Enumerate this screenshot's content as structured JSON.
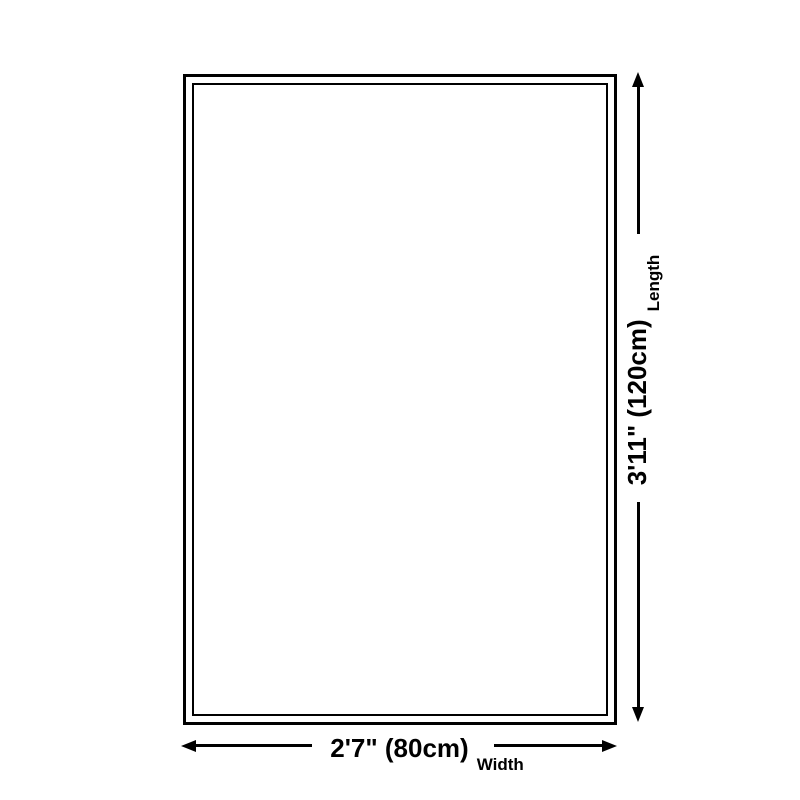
{
  "page": {
    "background_color": "#ffffff",
    "line_color": "#000000"
  },
  "diagram": {
    "type": "product-size-diagram",
    "shape": "rectangle-with-inner-border",
    "length": {
      "value": "3'11\" (120cm)",
      "label": "Length"
    },
    "width": {
      "value": "2'7\" (80cm)",
      "label": "Width"
    }
  }
}
